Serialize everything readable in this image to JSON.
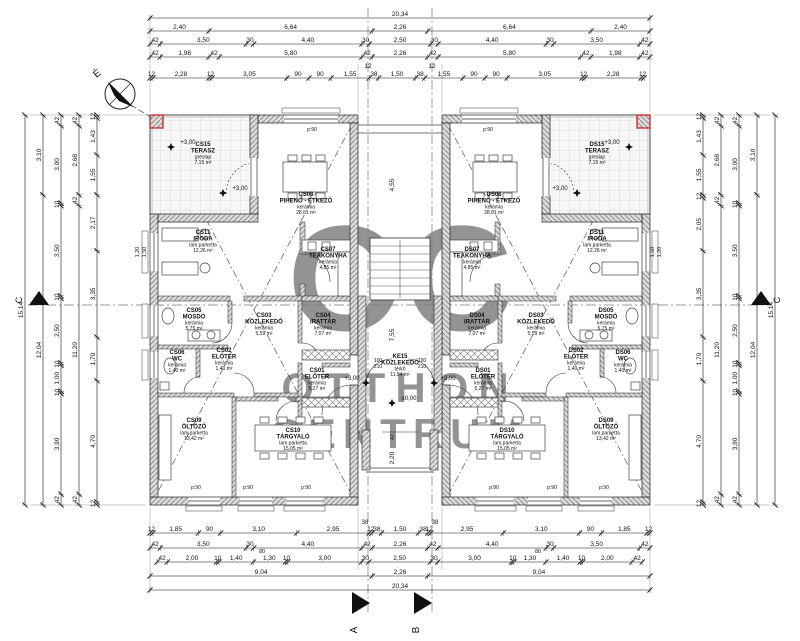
{
  "compass": {
    "north": "É"
  },
  "watermark": {
    "initials": "OC",
    "word1": "OTTHON",
    "word2": "CENTRUM",
    "color": "#b3aba2"
  },
  "markers": {
    "a": "A",
    "b": "B",
    "left": "C",
    "right": "C"
  },
  "levels": {
    "upper": "+3,00",
    "ground": "±0,00"
  },
  "parapet_label": "p:90",
  "accent_red": "#cc2222",
  "rooms": {
    "left": [
      {
        "code": "CS15",
        "name": "TERASZ",
        "floor": "greslap",
        "area": "7,15 m²"
      },
      {
        "code": "CS11",
        "name": "IRODA",
        "floor": "lam.parketta",
        "area": "12,26 m²"
      },
      {
        "code": "CS08",
        "name": "PIHENŐ - ÉTKEZŐ",
        "floor": "kerámia",
        "area": "28,61 m²"
      },
      {
        "code": "CS07",
        "name": "TEAKONYHA",
        "floor": "kerámia",
        "area": "4,85 m²"
      },
      {
        "code": "CS05",
        "name": "MOSDÓ",
        "floor": "kerámia",
        "area": "5,75 m²"
      },
      {
        "code": "CS03",
        "name": "KÖZLEKEDŐ",
        "floor": "kerámia",
        "area": "5,59 m²"
      },
      {
        "code": "CS04",
        "name": "IRATTÁR",
        "floor": "kerámia",
        "area": "7,07 m²"
      },
      {
        "code": "CS06",
        "name": "WC",
        "floor": "kerámia",
        "area": "1,40 m²"
      },
      {
        "code": "CS02",
        "name": "ELŐTÉR",
        "floor": "kerámia",
        "area": "1,40 m²"
      },
      {
        "code": "CS01",
        "name": "ELŐTÉR",
        "floor": "kerámia",
        "area": "5,27 m²"
      },
      {
        "code": "CS09",
        "name": "ÖLTÖZŐ",
        "floor": "lam.parketta",
        "area": "13,42 m²"
      },
      {
        "code": "CS10",
        "name": "TÁRGYALÓ",
        "floor": "lam.parketta",
        "area": "15,05 m²"
      }
    ],
    "right": [
      {
        "code": "DS15",
        "name": "TERASZ",
        "floor": "greslap",
        "area": "7,15 m²"
      },
      {
        "code": "DS11",
        "name": "IRODA",
        "floor": "lam.parketta",
        "area": "12,26 m²"
      },
      {
        "code": "DS08",
        "name": "PIHENŐ - ÉTKEZŐ",
        "floor": "kerámia",
        "area": "28,61 m²"
      },
      {
        "code": "DS07",
        "name": "TEAKONYHA",
        "floor": "kerámia",
        "area": "4,85 m²"
      },
      {
        "code": "DS05",
        "name": "MOSDÓ",
        "floor": "kerámia",
        "area": "5,75 m²"
      },
      {
        "code": "DS03",
        "name": "KÖZLEKEDŐ",
        "floor": "kerámia",
        "area": "5,59 m²"
      },
      {
        "code": "DS04",
        "name": "IRATTÁR",
        "floor": "kerámia",
        "area": "7,07 m²"
      },
      {
        "code": "DS06",
        "name": "WC",
        "floor": "kerámia",
        "area": "1,40 m²"
      },
      {
        "code": "DS02",
        "name": "ELŐTÉR",
        "floor": "kerámia",
        "area": "1,40 m²"
      },
      {
        "code": "DS01",
        "name": "ELŐTÉR",
        "floor": "kerámia",
        "area": "5,27 m²"
      },
      {
        "code": "DS09",
        "name": "ÖLTÖZŐ",
        "floor": "lam.parketta",
        "area": "13,42 m²"
      },
      {
        "code": "DS10",
        "name": "TÁRGYALÓ",
        "floor": "lam.parketta",
        "area": "15,05 m²"
      }
    ],
    "center": {
      "code": "KE15",
      "name": "KÖZLEKEDŐ",
      "floor": "térkő",
      "area": "11,54 m²"
    }
  },
  "dimensions": {
    "top": [
      [
        "20,34"
      ],
      [
        "2,40",
        "6,64",
        "2,26",
        "6,64",
        "2,40"
      ],
      [
        "42",
        "3,50",
        "30",
        "4,40",
        "30",
        "2,50",
        "30",
        "4,40",
        "30",
        "3,50",
        "42"
      ],
      [
        "42",
        "1,98",
        "42",
        "5,80",
        "42",
        "2,26",
        "42",
        "5,80",
        "42",
        "1,98",
        "42"
      ],
      [
        "12",
        "2,28",
        "12",
        "3,05",
        "90",
        "90",
        "1,55",
        "38",
        "1,50",
        "38",
        "1,55",
        "90",
        "90",
        "3,05",
        "12",
        "2,28",
        "12"
      ]
    ],
    "bottom": [
      [
        "12",
        "1,85",
        "90",
        "3,10",
        "2,95",
        "12",
        "38",
        "1,50",
        "38",
        "12",
        "2,95",
        "3,10",
        "90",
        "1,85",
        "12"
      ],
      [
        "42",
        "3,50",
        "30",
        "4,40",
        "42",
        "2,26",
        "42",
        "4,40",
        "30",
        "3,50",
        "42"
      ],
      [
        "42",
        "2,00",
        "10",
        "1,40",
        "1,30",
        "10",
        "3,00",
        "30",
        "2,50",
        "30",
        "3,00",
        "10",
        "1,30",
        "1,40",
        "10",
        "2,00",
        "42"
      ],
      [
        "9,04",
        "2,26",
        "9,04"
      ],
      [
        "20,34"
      ]
    ],
    "left": [
      [
        "15,14"
      ],
      [
        "3,10",
        "12,04"
      ],
      [
        "42",
        "3,00",
        "10",
        "3,50",
        "10",
        "2,50",
        "10",
        "1,00",
        "10",
        "3,90",
        "42"
      ],
      [
        "42",
        "2,68",
        "42",
        "11,20",
        "42"
      ],
      [
        "12",
        "1,43",
        "1,55",
        "2,17",
        "3,35",
        "1,70",
        "4,70",
        "12"
      ]
    ],
    "right": [
      [
        "12",
        "1,43",
        "1,55",
        "12",
        "2,05",
        "3,35",
        "1,70",
        "4,70",
        "12"
      ],
      [
        "42",
        "2,68",
        "42",
        "11,20",
        "42"
      ],
      [
        "42",
        "3,00",
        "10",
        "3,50",
        "10",
        "2,50",
        "10",
        "1,00",
        "10",
        "3,90",
        "42"
      ],
      [
        "3,10",
        "12,04"
      ],
      [
        "15,14"
      ]
    ]
  },
  "small_labels": [
    "12",
    "12",
    "80",
    "80",
    "4,55",
    "7,55",
    "42",
    "2,20",
    "1,20",
    "1,50",
    "1,20",
    "1,50",
    "100",
    "210",
    "100",
    "210",
    "38",
    "38"
  ],
  "door_note": "90/210"
}
